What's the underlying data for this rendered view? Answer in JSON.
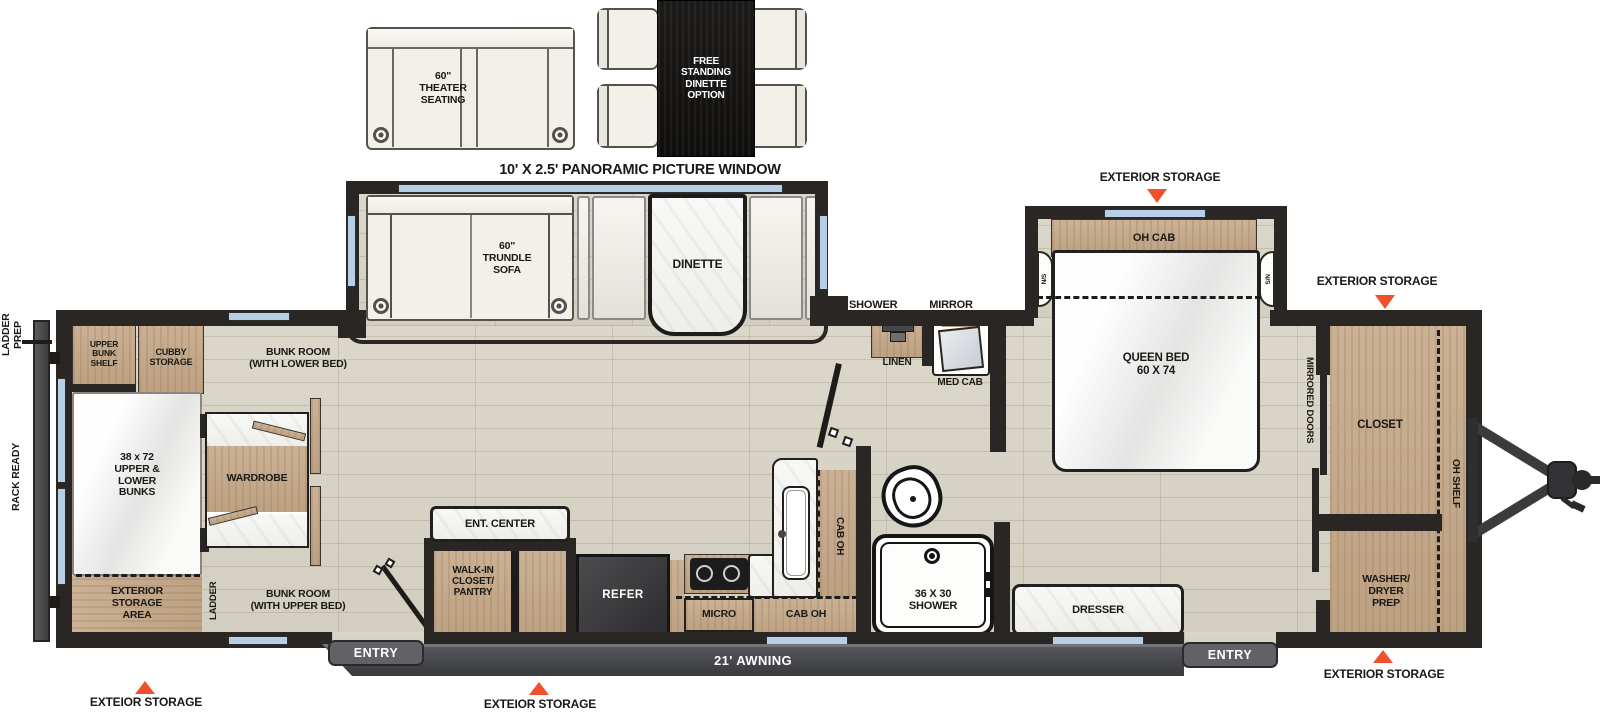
{
  "options_area": {
    "theater_seating": "60\"\nTHEATER\nSEATING",
    "free_dinette": "FREE\nSTANDING\nDINETTE\nOPTION",
    "picture_window": "10' X 2.5' PANORAMIC PICTURE WINDOW"
  },
  "living": {
    "trundle_sofa": "60\"\nTRUNDLE\nSOFA",
    "dinette": "DINETTE",
    "bunk_room_lower": "BUNK ROOM\n(WITH LOWER BED)",
    "bunk_room_upper": "BUNK ROOM\n(WITH UPPER BED)"
  },
  "bunk_area": {
    "upper_bunk_shelf": "UPPER\nBUNK\nSHELF",
    "cubby_storage": "CUBBY\nSTORAGE",
    "bunks": "38 x 72\nUPPER &\nLOWER\nBUNKS",
    "exterior_storage_area": "EXTERIOR\nSTORAGE\nAREA",
    "wardrobe": "WARDROBE",
    "ladder": "LADDER"
  },
  "exterior_left": {
    "ladder_prep": "LADDER\nPREP",
    "rack_ready": "RACK READY"
  },
  "kitchen": {
    "ent_center": "ENT. CENTER",
    "walk_in": "WALK-IN\nCLOSET/\nPANTRY",
    "refer": "REFER",
    "micro": "MICRO",
    "cab_oh_upper": "CAB OH",
    "cab_oh_lower": "CAB OH"
  },
  "bath": {
    "os_shower": "OS SHOWER",
    "mirror": "MIRROR",
    "linen": "LINEN",
    "med_cab": "MED CAB",
    "shower_36": "36 X 30\nSHOWER"
  },
  "bedroom": {
    "oh_cab": "OH CAB",
    "ns_left": "N/S",
    "ns_right": "N/S",
    "queen_bed": "QUEEN BED\n60 X 74",
    "mirrored_doors": "MIRRORED DOORS",
    "dresser": "DRESSER"
  },
  "front": {
    "closet": "CLOSET",
    "oh_shelf": "OH SHELF",
    "washer_dryer_prep": "WASHER/\nDRYER\nPREP"
  },
  "callouts": {
    "storage_top": "EXTERIOR STORAGE",
    "storage_front_side": "EXTERIOR STORAGE",
    "storage_rear_bottom": "EXTEIOR STORAGE",
    "storage_mid_bottom": "EXTEIOR STORAGE",
    "storage_front_bottom": "EXTERIOR STORAGE",
    "entry_left": "ENTRY",
    "entry_right": "ENTRY",
    "awning": "21' AWNING"
  },
  "colors": {
    "callout_triangle": "#F0502B",
    "wall": "#2A2623",
    "wood_cabinet": "#C7AE92",
    "floor": "#D8D4C6",
    "window": "#B7CFE6",
    "marble": "#F6F6F3"
  }
}
